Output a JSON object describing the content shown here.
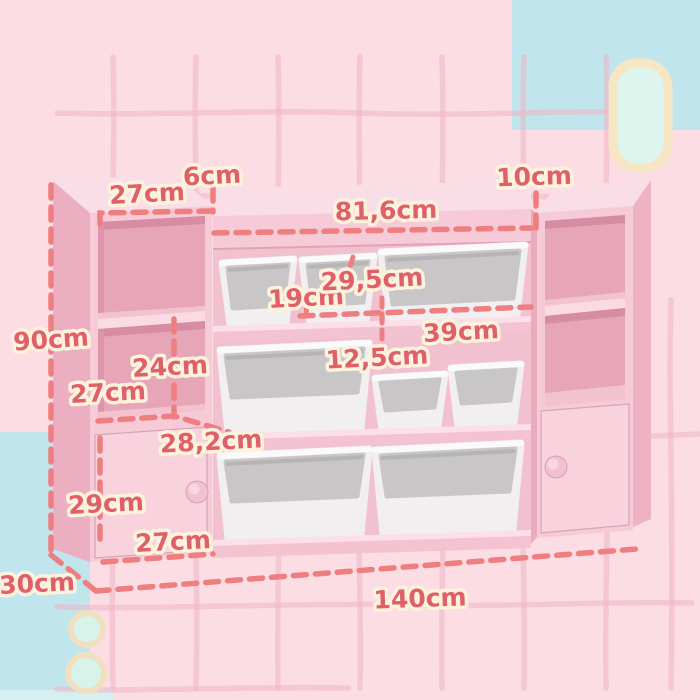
{
  "diagram": {
    "subject": "Kids pink toy storage organizer with white bins — dimension diagram",
    "unit_suffix": "cm",
    "measurements": {
      "top_shelf_width": "27cm",
      "top_edge_height": "6cm",
      "middle_section_width": "81,6cm",
      "right_edge_height": "10cm",
      "total_height": "90cm",
      "small_bin_width": "19cm",
      "bin_depth": "29,5cm",
      "large_bin_width": "39cm",
      "bin_height": "12,5cm",
      "shelf_compartment_height": "24cm",
      "side_compartment_width": "27cm",
      "bin_row_depth": "28,2cm",
      "cabinet_door_height": "29cm",
      "cabinet_door_width": "27cm",
      "unit_depth": "30cm",
      "total_width": "140cm"
    },
    "colors": {
      "background": "#fbdde3",
      "grid": "#f0b4c5",
      "accent_blue": "#c1e5ec",
      "accent_mint": "#def5ee",
      "accent_cream": "#f6e6c4",
      "furniture_pink_front": "#f6cad7",
      "furniture_pink_top": "#fadee7",
      "furniture_pink_side": "#ecafc2",
      "bin_white": "#f1eff0",
      "bin_gray": "#c9c6c8",
      "dimension_line": "#ee7e80",
      "dimension_text": "#e0606a",
      "dimension_text_outline": "#fdf2dd"
    }
  }
}
